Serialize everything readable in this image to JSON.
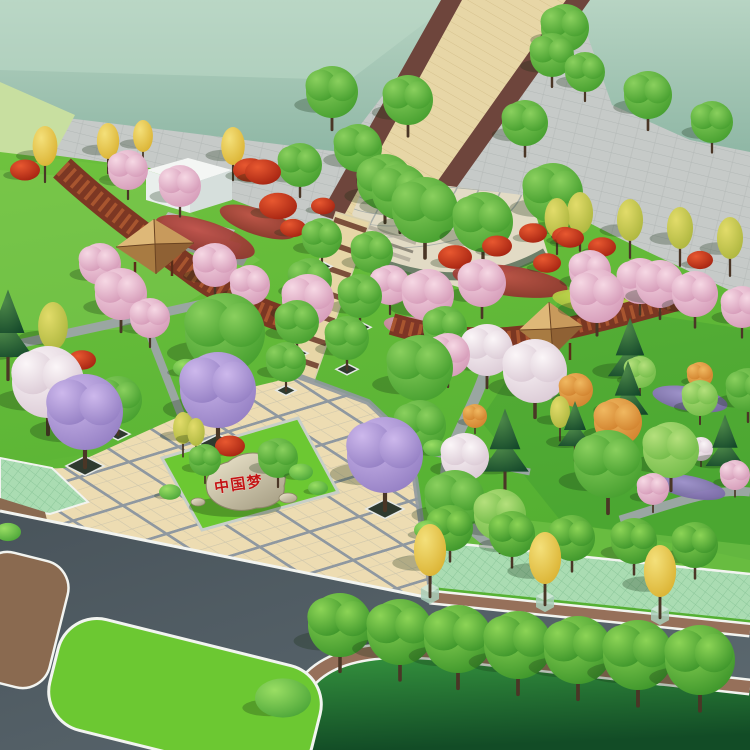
{
  "stone": {
    "inscription": "中国梦",
    "text_color": "#c41414"
  },
  "palette": {
    "sageTop": "#b7d4c3",
    "sageBottom": "#8fb7a5",
    "sageLight": "#d8e9dc",
    "grayPlaza": "#c6cac8",
    "grayBrick": "#b2b8b6",
    "walkBeige": "#e7d6a6",
    "walkEdge": "#6e453c",
    "walkLine": "#d6c28e",
    "tileCream": "#eddcb2",
    "tileLine": "#8f98a0",
    "fanBeige": "#e2dbc5",
    "fanLine": "#9aa3a2",
    "lawn1": "#6fc23e",
    "lawn2": "#54b032",
    "lawnYellow": "#c8dfa0",
    "lawnDark1": "#35933e",
    "lawnDark2": "#124c26",
    "islandGreen": "#6cc832",
    "hatchGreen": "#aadcb2",
    "hatchLine": "#8cc79a",
    "asphalt1": "#5d6a71",
    "asphalt2": "#49545b",
    "sidewalkBrown": "#96705a",
    "soil": "#8a6a50",
    "whiteLine": "#f2f4f0",
    "pathGray": "#9aa6a2",
    "pergola": "#7c3322",
    "pergolaLight": "#a8552f",
    "deckWood": "#b8834e",
    "roofFaceN": "#deb878",
    "roofFaceE": "#c89a5c",
    "roofFaceS": "#8f6134",
    "roofFaceW": "#a87b42",
    "roofRidge": "#6b4422",
    "tentWhite": "#f4f6f4",
    "tentFront": "#e9efec",
    "tentShade": "#d6dfdc",
    "stoneLight": "#efe8cf",
    "stoneDark": "#a8a086",
    "trunk": "#4a3626",
    "treeGreen1": "#8ad05e",
    "treeGreen2": "#3f9a2a",
    "treeGreenLight1": "#b4e07c",
    "treeGreenLight2": "#6cb844",
    "treeStreet1": "#8cd456",
    "treeStreet2": "#358f26",
    "conifer1": "#4f8a4a",
    "conifer2": "#14482a",
    "yellow1": "#f4e07a",
    "yellow2": "#d8ae2c",
    "yellowGreen1": "#e2dc6a",
    "yellowGreen2": "#a8b23a",
    "purple1": "#cdb8ec",
    "purple2": "#8f7ac0",
    "pink1": "#f6d8e4",
    "pink2": "#d295b4",
    "white1": "#fbf6f8",
    "white2": "#d8c6d2",
    "red1": "#e85830",
    "red2": "#9e1e0e",
    "orange1": "#f0b860",
    "orange2": "#cf7e2a",
    "shrub1": "#9ade64",
    "shrub2": "#44a034",
    "bedRed1": "#c05048",
    "bedRed2": "#7e2d26",
    "bedPurple1": "#a392d2",
    "bedPurple2": "#6a5a96",
    "bedRose1": "#e0a8bc",
    "bedRose2": "#b86a88",
    "bedYellow1": "#cadc50",
    "bedYellow2": "#96b236"
  },
  "scene": {
    "trees": [
      {
        "x": 332,
        "y": 92,
        "r": 26,
        "t": "g"
      },
      {
        "x": 408,
        "y": 100,
        "r": 25,
        "t": "g"
      },
      {
        "x": 385,
        "y": 182,
        "r": 28,
        "t": "g"
      },
      {
        "x": 358,
        "y": 148,
        "r": 24,
        "t": "g"
      },
      {
        "x": 300,
        "y": 165,
        "r": 22,
        "t": "g"
      },
      {
        "x": 525,
        "y": 123,
        "r": 23,
        "t": "g"
      },
      {
        "x": 552,
        "y": 55,
        "r": 22,
        "t": "g"
      },
      {
        "x": 585,
        "y": 72,
        "r": 20,
        "t": "g"
      },
      {
        "x": 565,
        "y": 28,
        "r": 24,
        "t": "g"
      },
      {
        "x": 648,
        "y": 95,
        "r": 24,
        "t": "g"
      },
      {
        "x": 712,
        "y": 122,
        "r": 21,
        "t": "g"
      },
      {
        "x": 45,
        "y": 146,
        "r": 20,
        "t": "y"
      },
      {
        "x": 108,
        "y": 141,
        "r": 18,
        "t": "y"
      },
      {
        "x": 143,
        "y": 136,
        "r": 16,
        "t": "y"
      },
      {
        "x": 233,
        "y": 146,
        "r": 19,
        "t": "y"
      },
      {
        "x": 25,
        "y": 170,
        "r": 15,
        "t": "rd"
      },
      {
        "x": 250,
        "y": 170,
        "r": 17,
        "t": "rd"
      },
      {
        "x": 128,
        "y": 170,
        "r": 20,
        "t": "pk"
      },
      {
        "x": 180,
        "y": 186,
        "r": 21,
        "t": "pk"
      },
      {
        "x": 263,
        "y": 172,
        "r": 18,
        "t": "rd"
      },
      {
        "x": 278,
        "y": 206,
        "r": 19,
        "t": "rd"
      },
      {
        "x": 8,
        "y": 336,
        "r": 30,
        "t": "dg"
      },
      {
        "x": 53,
        "y": 326,
        "r": 24,
        "t": "yg"
      },
      {
        "x": 121,
        "y": 294,
        "r": 26,
        "t": "pk"
      },
      {
        "x": 100,
        "y": 264,
        "r": 21,
        "t": "pk"
      },
      {
        "x": 48,
        "y": 382,
        "r": 36,
        "t": "wh"
      },
      {
        "x": 85,
        "y": 412,
        "r": 38,
        "t": "pu",
        "p": 1
      },
      {
        "x": 218,
        "y": 390,
        "r": 38,
        "t": "pu",
        "p": 1
      },
      {
        "x": 118,
        "y": 400,
        "r": 24,
        "t": "g",
        "p": 1
      },
      {
        "x": 308,
        "y": 300,
        "r": 26,
        "t": "pk"
      },
      {
        "x": 82,
        "y": 360,
        "r": 14,
        "t": "rd"
      },
      {
        "x": 225,
        "y": 333,
        "r": 40,
        "t": "g"
      },
      {
        "x": 150,
        "y": 318,
        "r": 20,
        "t": "pk"
      },
      {
        "x": 215,
        "y": 265,
        "r": 22,
        "t": "pk"
      },
      {
        "x": 250,
        "y": 285,
        "r": 20,
        "t": "pk"
      },
      {
        "x": 322,
        "y": 238,
        "r": 20,
        "t": "g",
        "p": 1
      },
      {
        "x": 310,
        "y": 280,
        "r": 22,
        "t": "g",
        "p": 1
      },
      {
        "x": 297,
        "y": 322,
        "r": 22,
        "t": "g",
        "p": 1
      },
      {
        "x": 286,
        "y": 362,
        "r": 20,
        "t": "g",
        "p": 1
      },
      {
        "x": 372,
        "y": 252,
        "r": 21,
        "t": "g",
        "p": 1
      },
      {
        "x": 360,
        "y": 296,
        "r": 22,
        "t": "g",
        "p": 1
      },
      {
        "x": 347,
        "y": 338,
        "r": 22,
        "t": "g",
        "p": 1
      },
      {
        "x": 420,
        "y": 368,
        "r": 33,
        "t": "g"
      },
      {
        "x": 445,
        "y": 328,
        "r": 22,
        "t": "g"
      },
      {
        "x": 425,
        "y": 210,
        "r": 33,
        "t": "g"
      },
      {
        "x": 483,
        "y": 222,
        "r": 30,
        "t": "g"
      },
      {
        "x": 553,
        "y": 193,
        "r": 30,
        "t": "g"
      },
      {
        "x": 400,
        "y": 192,
        "r": 28,
        "t": "g"
      },
      {
        "x": 557,
        "y": 218,
        "r": 20,
        "t": "yg"
      },
      {
        "x": 455,
        "y": 257,
        "r": 17,
        "t": "rd"
      },
      {
        "x": 497,
        "y": 246,
        "r": 15,
        "t": "rd"
      },
      {
        "x": 533,
        "y": 233,
        "r": 14,
        "t": "rd"
      },
      {
        "x": 570,
        "y": 238,
        "r": 14,
        "t": "rd"
      },
      {
        "x": 547,
        "y": 263,
        "r": 14,
        "t": "rd"
      },
      {
        "x": 293,
        "y": 228,
        "r": 13,
        "t": "rd"
      },
      {
        "x": 323,
        "y": 206,
        "r": 12,
        "t": "rd"
      },
      {
        "x": 580,
        "y": 213,
        "r": 21,
        "t": "yg"
      },
      {
        "x": 630,
        "y": 220,
        "r": 21,
        "t": "yg"
      },
      {
        "x": 680,
        "y": 228,
        "r": 21,
        "t": "yg"
      },
      {
        "x": 730,
        "y": 238,
        "r": 21,
        "t": "yg"
      },
      {
        "x": 565,
        "y": 236,
        "r": 13,
        "t": "rd"
      },
      {
        "x": 602,
        "y": 247,
        "r": 14,
        "t": "rd"
      },
      {
        "x": 700,
        "y": 260,
        "r": 13,
        "t": "rd"
      },
      {
        "x": 590,
        "y": 271,
        "r": 21,
        "t": "pk"
      },
      {
        "x": 640,
        "y": 281,
        "r": 23,
        "t": "pk"
      },
      {
        "x": 695,
        "y": 294,
        "r": 23,
        "t": "pk"
      },
      {
        "x": 742,
        "y": 307,
        "r": 21,
        "t": "pk"
      },
      {
        "x": 428,
        "y": 295,
        "r": 26,
        "t": "pk"
      },
      {
        "x": 390,
        "y": 285,
        "r": 20,
        "t": "pk"
      },
      {
        "x": 482,
        "y": 283,
        "r": 24,
        "t": "pk"
      },
      {
        "x": 597,
        "y": 296,
        "r": 27,
        "t": "pk"
      },
      {
        "x": 660,
        "y": 284,
        "r": 24,
        "t": "pk"
      },
      {
        "x": 535,
        "y": 371,
        "r": 32,
        "t": "wh"
      },
      {
        "x": 487,
        "y": 350,
        "r": 26,
        "t": "wh"
      },
      {
        "x": 448,
        "y": 355,
        "r": 22,
        "t": "pk"
      },
      {
        "x": 630,
        "y": 358,
        "r": 26,
        "t": "dg"
      },
      {
        "x": 700,
        "y": 375,
        "r": 13,
        "t": "or"
      },
      {
        "x": 576,
        "y": 390,
        "r": 17,
        "t": "or"
      },
      {
        "x": 618,
        "y": 422,
        "r": 24,
        "t": "or"
      },
      {
        "x": 628,
        "y": 398,
        "r": 24,
        "t": "dg"
      },
      {
        "x": 575,
        "y": 432,
        "r": 20,
        "t": "dg"
      },
      {
        "x": 725,
        "y": 450,
        "r": 23,
        "t": "dg"
      },
      {
        "x": 608,
        "y": 464,
        "r": 34,
        "t": "g"
      },
      {
        "x": 671,
        "y": 450,
        "r": 28,
        "t": "gl"
      },
      {
        "x": 653,
        "y": 489,
        "r": 16,
        "t": "pk"
      },
      {
        "x": 735,
        "y": 475,
        "r": 15,
        "t": "pk"
      },
      {
        "x": 701,
        "y": 449,
        "r": 12,
        "t": "wh"
      },
      {
        "x": 748,
        "y": 390,
        "r": 22,
        "t": "g"
      },
      {
        "x": 700,
        "y": 398,
        "r": 18,
        "t": "gl"
      },
      {
        "x": 640,
        "y": 372,
        "r": 16,
        "t": "gl"
      },
      {
        "x": 560,
        "y": 412,
        "r": 16,
        "t": "yg"
      },
      {
        "x": 420,
        "y": 426,
        "r": 26,
        "t": "g"
      },
      {
        "x": 465,
        "y": 457,
        "r": 24,
        "t": "wh"
      },
      {
        "x": 505,
        "y": 452,
        "r": 28,
        "t": "dg"
      },
      {
        "x": 475,
        "y": 416,
        "r": 12,
        "t": "or"
      },
      {
        "x": 455,
        "y": 500,
        "r": 30,
        "t": "g"
      },
      {
        "x": 500,
        "y": 515,
        "r": 26,
        "t": "gl"
      },
      {
        "x": 428,
        "y": 530,
        "r": 14,
        "t": "sh"
      },
      {
        "x": 230,
        "y": 446,
        "r": 15,
        "t": "rd"
      },
      {
        "x": 278,
        "y": 458,
        "r": 20,
        "t": "g"
      },
      {
        "x": 205,
        "y": 460,
        "r": 16,
        "t": "g"
      },
      {
        "x": 196,
        "y": 432,
        "r": 14,
        "t": "yg"
      },
      {
        "x": 183,
        "y": 428,
        "r": 16,
        "t": "yg"
      },
      {
        "x": 301,
        "y": 472,
        "r": 12,
        "t": "sh"
      },
      {
        "x": 318,
        "y": 488,
        "r": 10,
        "t": "sh"
      },
      {
        "x": 170,
        "y": 492,
        "r": 11,
        "t": "sh"
      },
      {
        "x": 385,
        "y": 455,
        "r": 38,
        "t": "pu",
        "p": 1
      },
      {
        "x": 186,
        "y": 368,
        "r": 13,
        "t": "sh"
      },
      {
        "x": 225,
        "y": 373,
        "r": 12,
        "t": "sh"
      },
      {
        "x": 392,
        "y": 432,
        "r": 14,
        "t": "sh"
      },
      {
        "x": 435,
        "y": 448,
        "r": 12,
        "t": "sh"
      },
      {
        "x": 450,
        "y": 528,
        "r": 23,
        "t": "st"
      },
      {
        "x": 512,
        "y": 534,
        "r": 23,
        "t": "st"
      },
      {
        "x": 572,
        "y": 538,
        "r": 23,
        "t": "st"
      },
      {
        "x": 634,
        "y": 541,
        "r": 23,
        "t": "st"
      },
      {
        "x": 695,
        "y": 545,
        "r": 23,
        "t": "st"
      },
      {
        "x": 430,
        "y": 550,
        "r": 26,
        "t": "y",
        "c": 1
      },
      {
        "x": 545,
        "y": 558,
        "r": 26,
        "t": "y",
        "c": 1
      },
      {
        "x": 660,
        "y": 571,
        "r": 26,
        "t": "y",
        "c": 1
      },
      {
        "x": 340,
        "y": 625,
        "r": 32,
        "t": "st"
      },
      {
        "x": 400,
        "y": 632,
        "r": 33,
        "t": "st"
      },
      {
        "x": 458,
        "y": 639,
        "r": 34,
        "t": "st"
      },
      {
        "x": 518,
        "y": 645,
        "r": 34,
        "t": "st"
      },
      {
        "x": 578,
        "y": 650,
        "r": 34,
        "t": "st"
      },
      {
        "x": 638,
        "y": 655,
        "r": 35,
        "t": "st"
      },
      {
        "x": 700,
        "y": 660,
        "r": 35,
        "t": "st"
      },
      {
        "x": 283,
        "y": 698,
        "r": 28,
        "t": "sh"
      },
      {
        "x": 8,
        "y": 532,
        "r": 13,
        "t": "sh"
      }
    ],
    "beds": [
      {
        "x": 205,
        "y": 237,
        "rx": 52,
        "ry": 16,
        "rot": 18,
        "t": "red"
      },
      {
        "x": 258,
        "y": 222,
        "rx": 40,
        "ry": 13,
        "rot": 18,
        "t": "red"
      },
      {
        "x": 510,
        "y": 281,
        "rx": 58,
        "ry": 15,
        "rot": 8,
        "t": "red"
      },
      {
        "x": 600,
        "y": 303,
        "rx": 48,
        "ry": 12,
        "rot": 8,
        "t": "yellow"
      },
      {
        "x": 690,
        "y": 487,
        "rx": 36,
        "ry": 11,
        "rot": 12,
        "t": "purple"
      },
      {
        "x": 690,
        "y": 399,
        "rx": 38,
        "ry": 12,
        "rot": 10,
        "t": "purple"
      },
      {
        "x": 425,
        "y": 331,
        "rx": 42,
        "ry": 12,
        "rot": 12,
        "t": "rose"
      }
    ]
  }
}
